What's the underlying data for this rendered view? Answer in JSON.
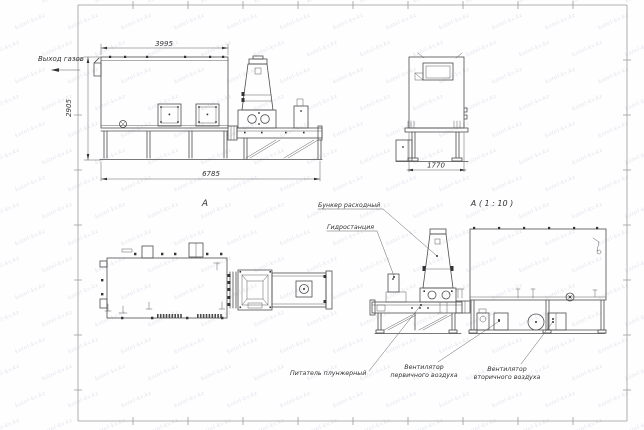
{
  "colors": {
    "background": "#fefefe",
    "line": "#4d4d4d",
    "text": "#333333",
    "watermark": "#c9cde0"
  },
  "watermark": {
    "text": "kotel-kv.kz"
  },
  "side_view": {
    "gas_outlet_label": "Выход газов",
    "dim_top": "3995",
    "dim_left": "2905",
    "dim_bottom": "6785"
  },
  "end_view": {
    "dim_width": "1770"
  },
  "plan_view": {
    "view_label": "A"
  },
  "detail_view": {
    "view_label": "A ( 1 : 10 )",
    "callout_hopper": "Бункер расходный",
    "callout_hydraulic": "Гидростанция",
    "callout_feeder": "Питатель плунжерный",
    "callout_primary_fan_1": "Вентилятор",
    "callout_primary_fan_2": "первичного воздуха",
    "callout_secondary_fan_1": "Вентилятор",
    "callout_secondary_fan_2": "вторичного воздуха"
  }
}
